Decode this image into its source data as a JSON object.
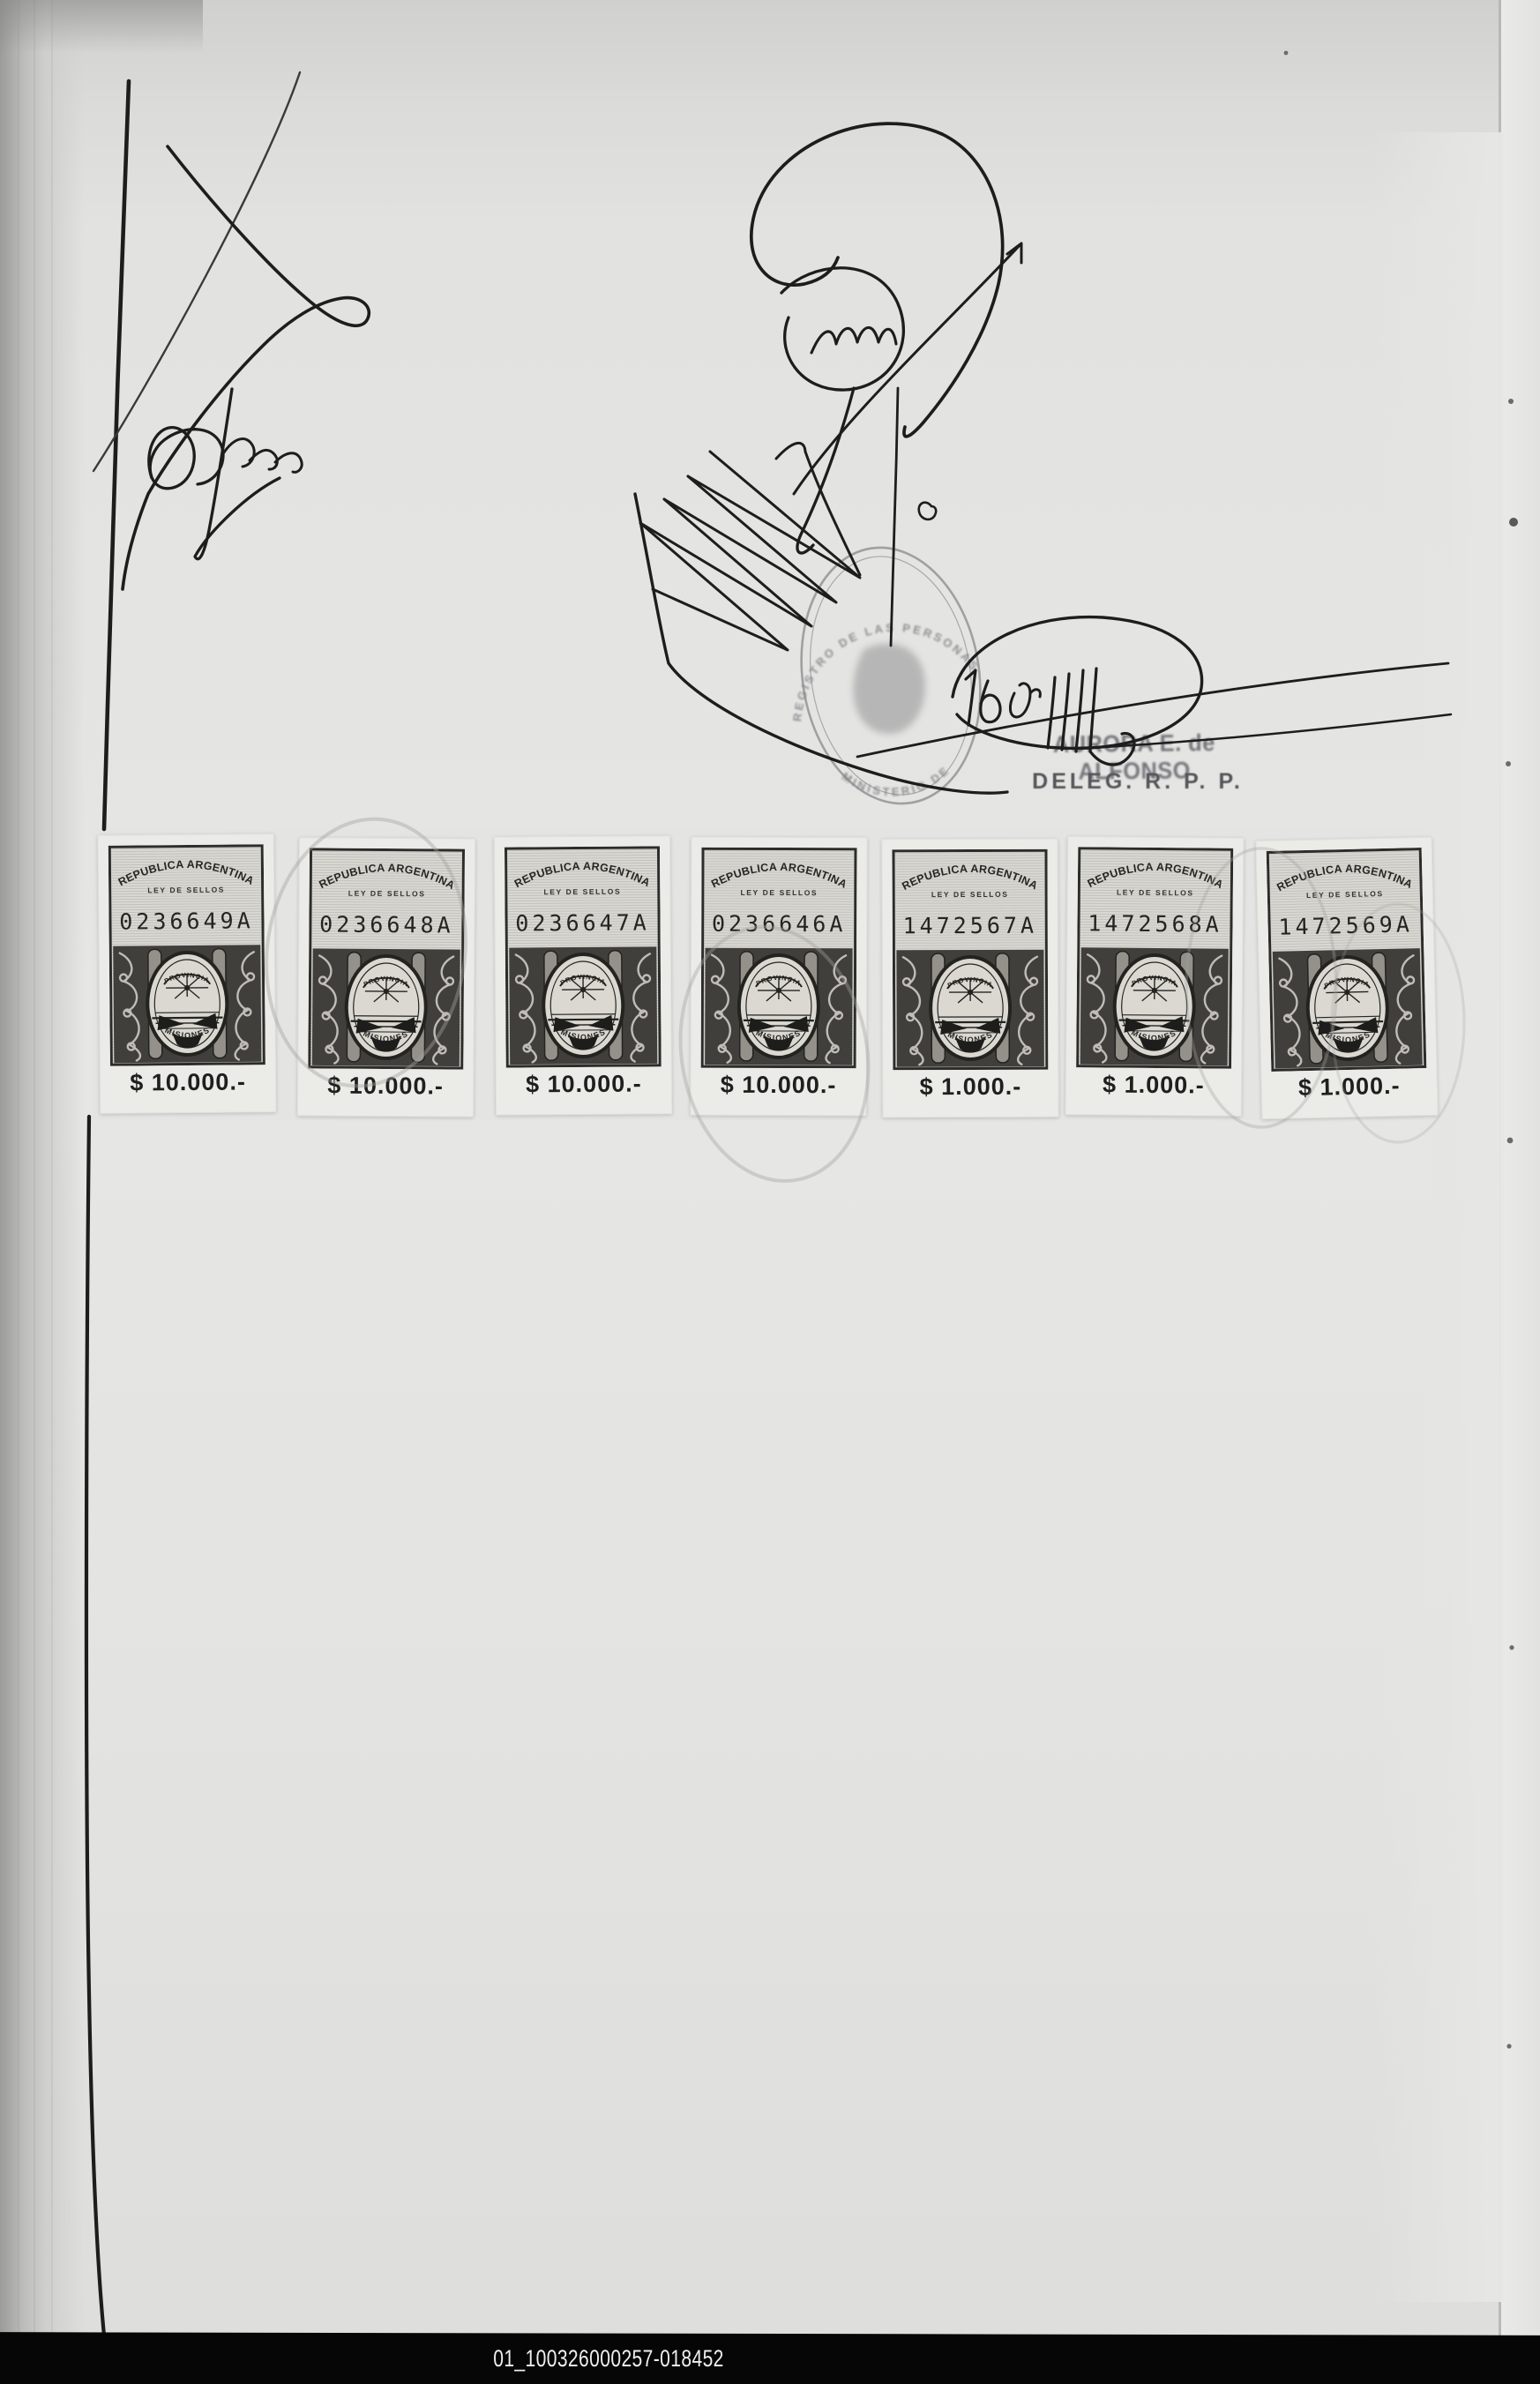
{
  "footer": {
    "code": "01_100326000257-018452"
  },
  "stamps": {
    "common": {
      "country": "REPUBLICA ARGENTINA",
      "law": "LEY DE SELLOS",
      "emblem_top": "PROVINCIA",
      "emblem_bottom": "MISIONES"
    },
    "items": [
      {
        "serial": "0236649A",
        "value": "$ 10.000.-"
      },
      {
        "serial": "0236648A",
        "value": "$ 10.000.-"
      },
      {
        "serial": "0236647A",
        "value": "$ 10.000.-"
      },
      {
        "serial": "0236646A",
        "value": "$ 10.000.-"
      },
      {
        "serial": "1472567A",
        "value": "$ 1.000.-"
      },
      {
        "serial": "1472568A",
        "value": "$ 1.000.-"
      },
      {
        "serial": "1472569A",
        "value": "$ 1.000.-"
      }
    ]
  },
  "seal": {
    "rim_top": "REGISTRO DE LAS PERSONAS",
    "rim_bottom": "MINISTERIO DE"
  },
  "officials": {
    "name_stamp": "AURORA E. de ALFONSO",
    "role_stamp": "DELEG. R. P. P."
  },
  "annotation": {
    "date_note": "16 de M"
  },
  "colors": {
    "page": "#e3e3e1",
    "ink": "#1d1d1d",
    "stamp_ink": "#2c2c2a",
    "seal": "#8d8d90",
    "footer_bg": "#060606",
    "footer_text": "#efefef"
  }
}
